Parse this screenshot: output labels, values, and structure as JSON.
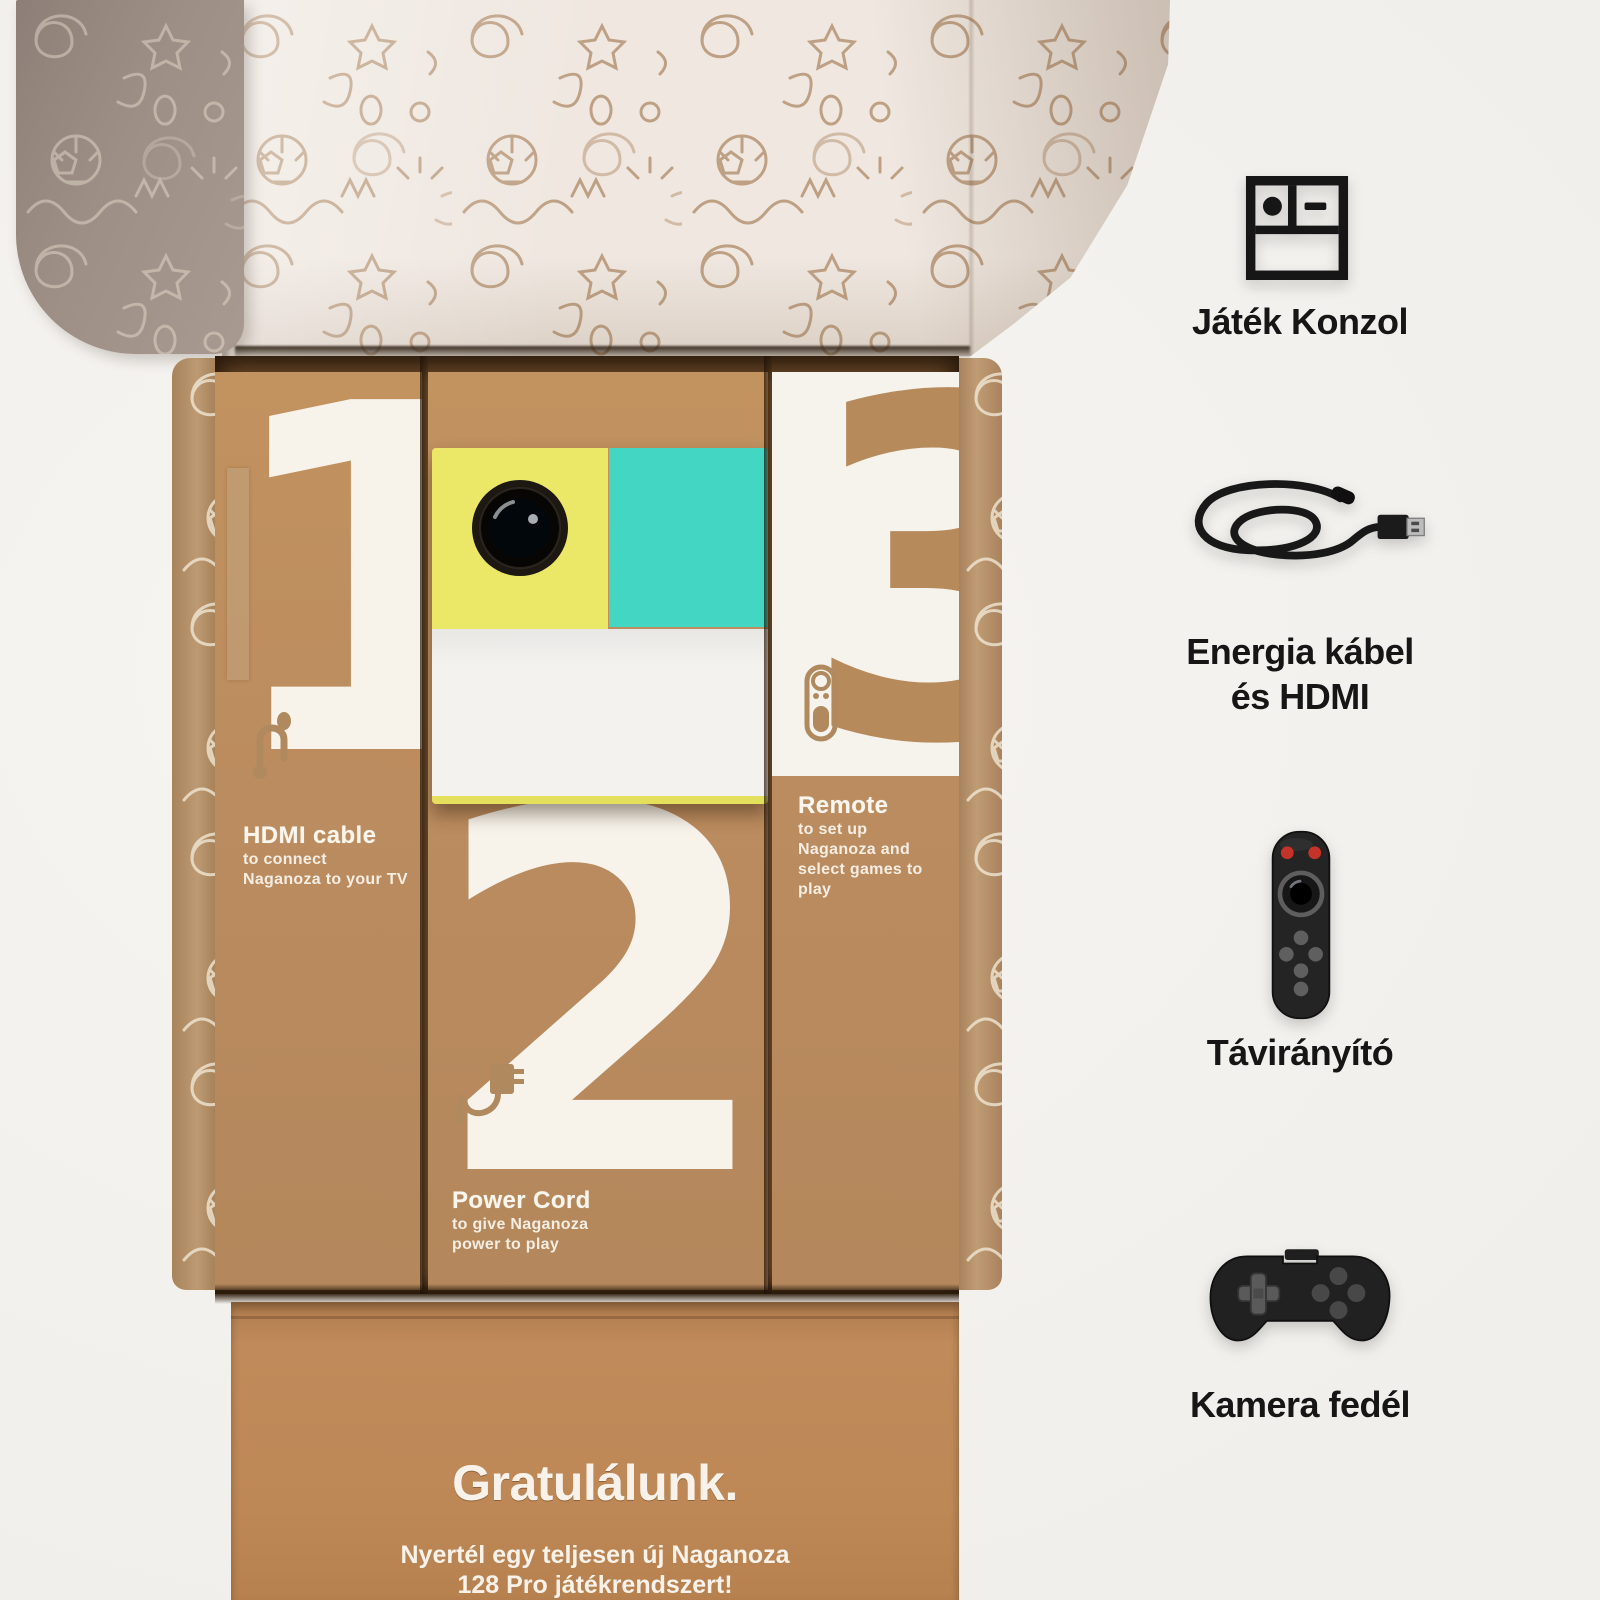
{
  "product_box": {
    "boxes": [
      {
        "number": "1",
        "title": "HDMI cable",
        "desc_lines": [
          "to connect",
          "Naganoza to your TV"
        ],
        "icon": "hdmi-cable-icon"
      },
      {
        "number": "2",
        "title": "Power Cord",
        "desc_lines": [
          "to give Naganoza",
          "power to play"
        ],
        "icon": "power-adapter-icon"
      },
      {
        "number": "3",
        "title": "Remote",
        "desc_lines": [
          "to set up",
          "Naganoza and",
          "select games to play"
        ],
        "icon": "remote-outline-icon"
      }
    ],
    "front_panel": {
      "heading": "Gratulálunk.",
      "sub_lines": [
        "Nyertél egy teljesen új Naganoza",
        "128 Pro játékrendszert!"
      ]
    }
  },
  "sidebar": {
    "items": [
      {
        "icon": "game-console-icon",
        "label_lines": [
          "Játék Konzol"
        ]
      },
      {
        "icon": "power-hdmi-cable-photo",
        "label_lines": [
          "Energia kábel",
          "és HDMI"
        ]
      },
      {
        "icon": "remote-control-photo",
        "label_lines": [
          "Távirányító"
        ]
      },
      {
        "icon": "gamepad-icon",
        "label_lines": [
          "Kamera fedél"
        ]
      }
    ]
  },
  "device": {
    "features": [
      "camera-lens",
      "status-dash"
    ]
  },
  "colors": {
    "background": "#f1efeb",
    "kraft": "#bb8c5f",
    "kraft_deep": "#6e4c2c",
    "kraft_panel": "#c08a5a",
    "lid": "#efe7e0",
    "flap": "#9e8f86",
    "panel_white": "#f6f3ec",
    "yellow": "#ebe767",
    "teal": "#43d6c3",
    "teal_dark": "#16a292",
    "device_white": "#f3f2ef",
    "number_white": "#f7f3ea",
    "doodle_brown": "#ab8460",
    "doodle_white": "#f3ead9",
    "red": "#c4332a",
    "ink": "#161616"
  }
}
